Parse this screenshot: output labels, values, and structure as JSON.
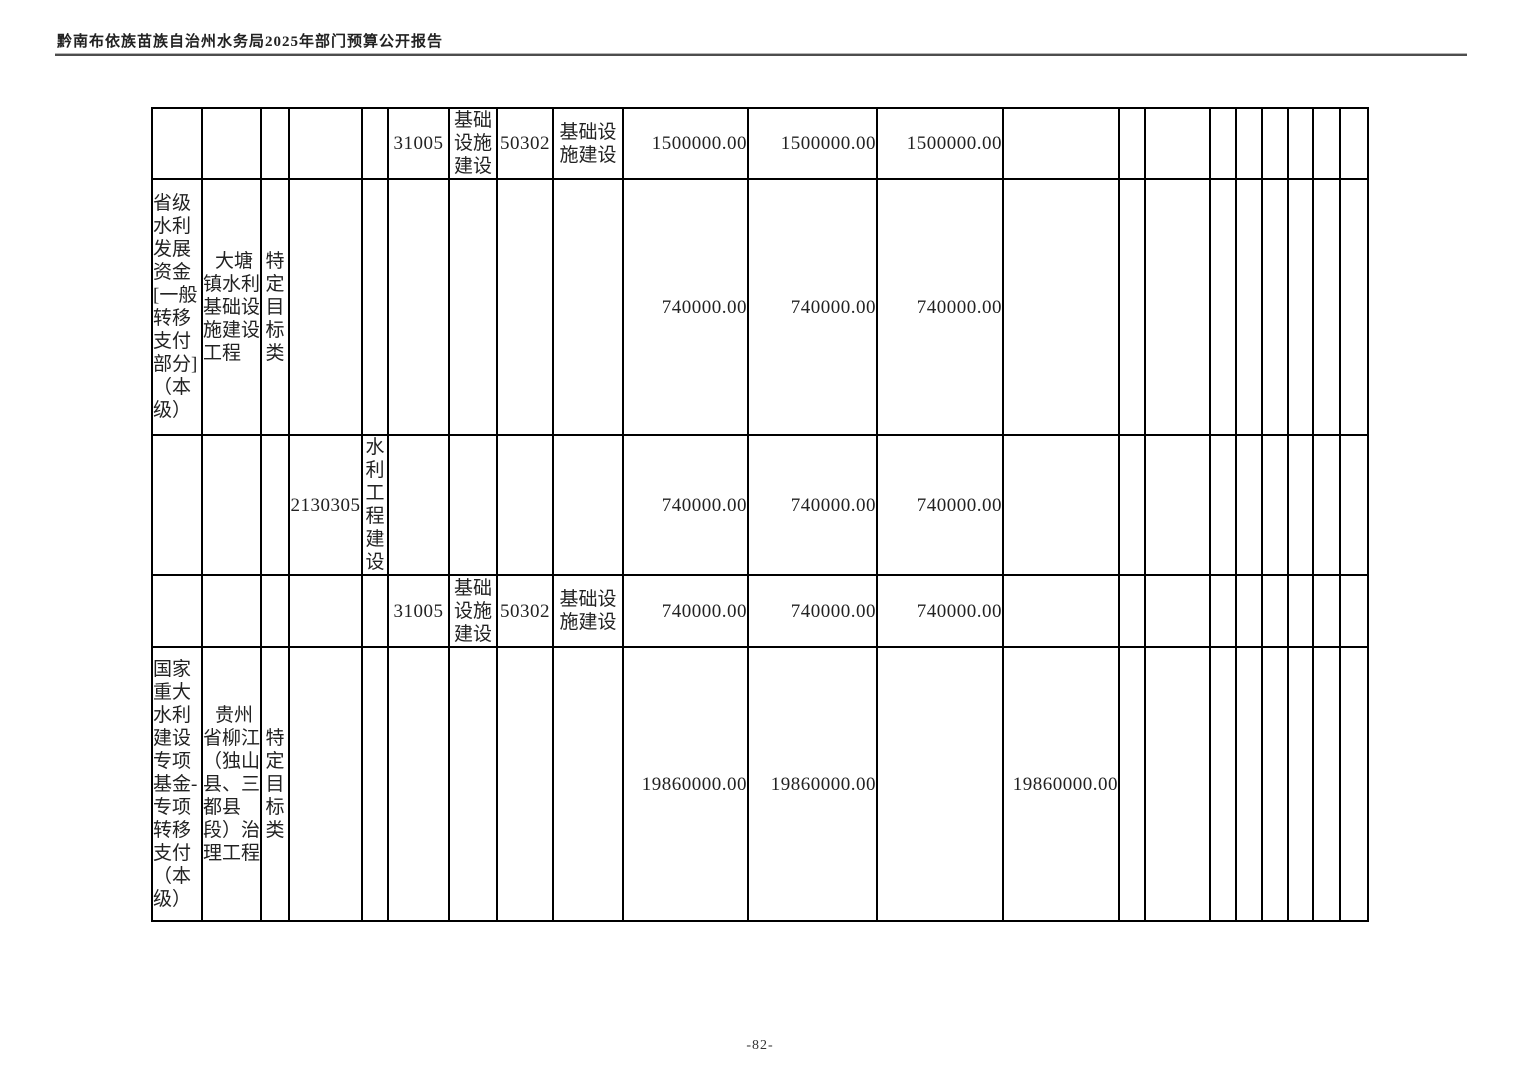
{
  "page": {
    "header_title": "黔南布依族苗族自治州水务局2025年部门预算公开报告",
    "footer_page_number": "-82-"
  },
  "table": {
    "rows": [
      [
        "",
        "",
        "",
        "",
        "",
        "31005",
        "基础设施建设",
        "50302",
        "基础设施建设",
        "1500000.00",
        "1500000.00",
        "1500000.00",
        "",
        "",
        "",
        "",
        "",
        "",
        "",
        "",
        ""
      ],
      [
        "省级水利发展资金[一般转移支付部分]（本级）",
        "大塘镇水利基础设施建设工程",
        "特定目标类",
        "",
        "",
        "",
        "",
        "",
        "",
        "740000.00",
        "740000.00",
        "740000.00",
        "",
        "",
        "",
        "",
        "",
        "",
        "",
        "",
        ""
      ],
      [
        "",
        "",
        "",
        "2130305",
        "水利工程建设",
        "",
        "",
        "",
        "",
        "740000.00",
        "740000.00",
        "740000.00",
        "",
        "",
        "",
        "",
        "",
        "",
        "",
        "",
        ""
      ],
      [
        "",
        "",
        "",
        "",
        "",
        "31005",
        "基础设施建设",
        "50302",
        "基础设施建设",
        "740000.00",
        "740000.00",
        "740000.00",
        "",
        "",
        "",
        "",
        "",
        "",
        "",
        "",
        ""
      ],
      [
        "国家重大水利建设专项基金-专项转移支付（本级）",
        "贵州省柳江（独山县、三都县段）治理工程",
        "特定目标类",
        "",
        "",
        "",
        "",
        "",
        "",
        "19860000.00",
        "19860000.00",
        "",
        "19860000.00",
        "",
        "",
        "",
        "",
        "",
        "",
        "",
        ""
      ]
    ]
  }
}
